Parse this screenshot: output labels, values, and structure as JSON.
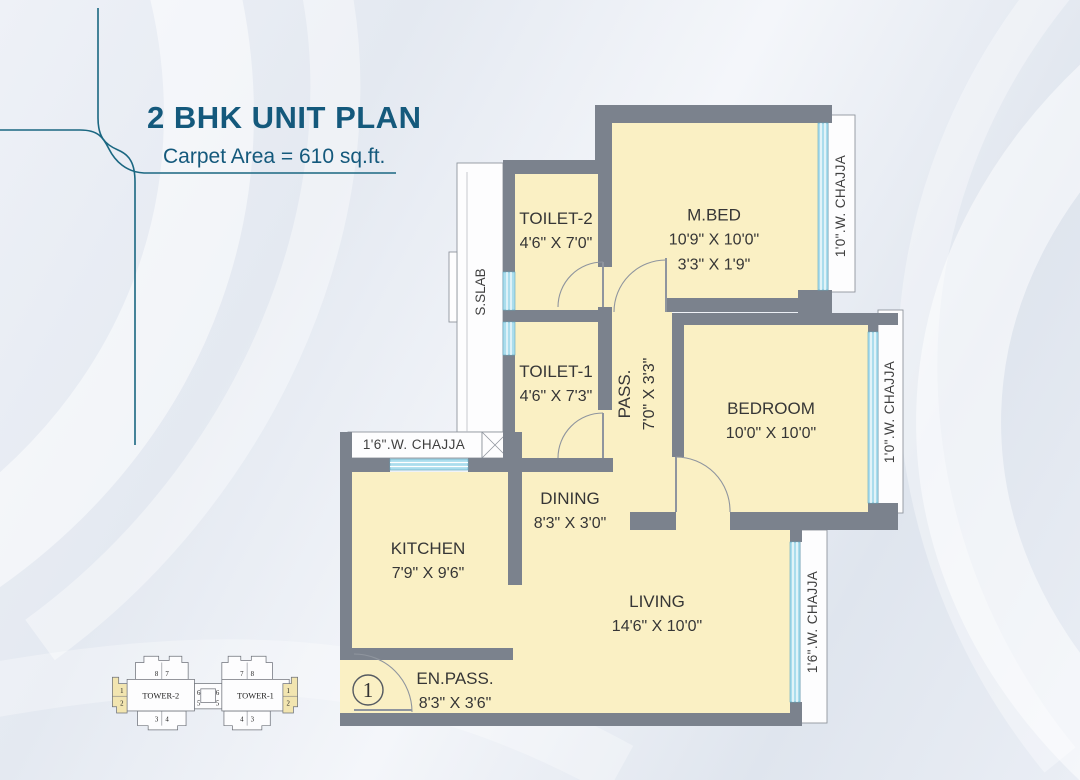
{
  "header": {
    "title": "2 BHK UNIT PLAN",
    "subtitle": "Carpet Area = 610 sq.ft."
  },
  "rooms": [
    {
      "name": "M.BED",
      "dim1": "10'9\" X 10'0\"",
      "dim2": "3'3\" X 1'9\""
    },
    {
      "name": "TOILET-2",
      "dim1": "4'6\" X 7'0\""
    },
    {
      "name": "TOILET-1",
      "dim1": "4'6\" X 7'3\""
    },
    {
      "name": "PASS.",
      "dim1": "7'0\" X 3'3\""
    },
    {
      "name": "BEDROOM",
      "dim1": "10'0\" X 10'0\""
    },
    {
      "name": "DINING",
      "dim1": "8'3\" X 3'0\""
    },
    {
      "name": "KITCHEN",
      "dim1": "7'9\" X 9'6\""
    },
    {
      "name": "LIVING",
      "dim1": "14'6\" X 10'0\""
    },
    {
      "name": "EN.PASS.",
      "dim1": "8'3\" X 3'6\""
    }
  ],
  "annotations": {
    "sslab": "S.SLAB",
    "chajja_mbed": "1'0\".W. CHAJJA",
    "chajja_bedroom": "1'0\".W. CHAJJA",
    "chajja_living": "1'6\".W. CHAJJA",
    "chajja_kitchen": "1'6\".W. CHAJJA",
    "entrance_number": "1"
  },
  "keyplan": {
    "tower2": {
      "label": "TOWER-2",
      "top_left": "8",
      "top_right": "7",
      "bottom_left": "3",
      "bottom_right": "4",
      "side_upper": "6",
      "side_lower": "5",
      "unit_upper": "1",
      "unit_lower": "2"
    },
    "tower1": {
      "label": "TOWER-1",
      "top_left": "7",
      "top_right": "8",
      "bottom_left": "4",
      "bottom_right": "3",
      "side_upper": "6",
      "side_lower": "5",
      "unit_upper": "1",
      "unit_lower": "2"
    }
  },
  "colors": {
    "accent": "#14597c",
    "wall": "#7b828d",
    "floor": "#faf0c4",
    "window": "#aadded",
    "keyplan_highlight": "#f2e5b0"
  }
}
